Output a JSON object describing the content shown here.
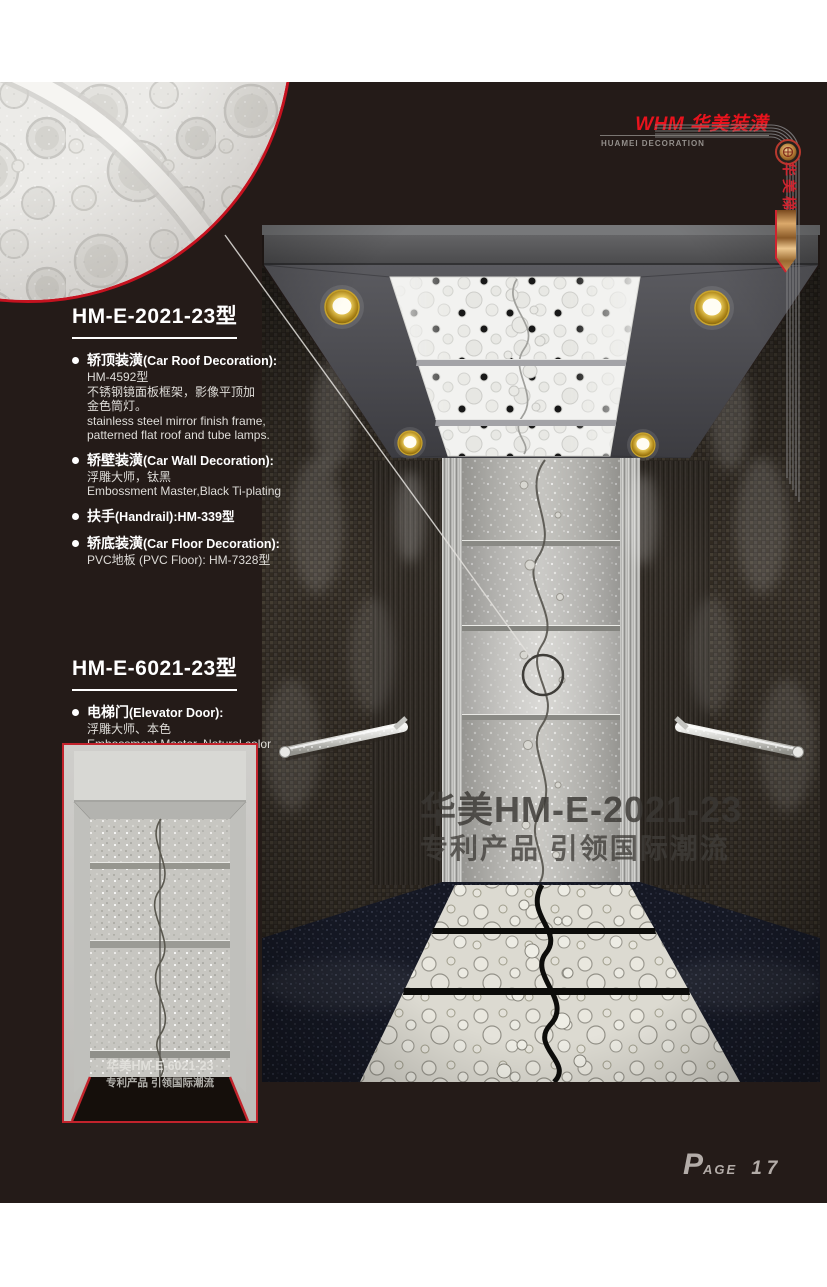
{
  "page": {
    "panel_color": "#241b18",
    "accent_red": "#c5121f",
    "footer": {
      "page_word_initial": "P",
      "page_word_rest": "AGE",
      "page_number": "17"
    }
  },
  "header": {
    "logo_title": "WHM 华美装潢",
    "logo_subtitle": "HUAMEI DECORATION",
    "banner_vertical_text": "华美梯"
  },
  "sections": [
    {
      "heading": "HM-E-2021-23型",
      "items": [
        {
          "zh": "轿顶装潢",
          "en": "(Car Roof Decoration):",
          "lines": [
            "HM-4592型",
            "不锈钢镜面板框架，影像平顶加",
            "金色筒灯。",
            "stainless steel mirror finish frame,",
            "patterned flat roof and tube lamps."
          ]
        },
        {
          "zh": "轿壁装潢",
          "en": "(Car Wall Decoration):",
          "lines": [
            "浮雕大师，钛黑",
            "Embossment Master,Black Ti-plating"
          ]
        },
        {
          "zh": "扶手",
          "en": "(Handrail):HM-339型",
          "lines": []
        },
        {
          "zh": "轿底装潢",
          "en": "(Car Floor Decoration):",
          "lines": [
            "PVC地板 (PVC Floor): HM-7328型"
          ]
        }
      ]
    },
    {
      "heading": "HM-E-6021-23型",
      "items": [
        {
          "zh": "电梯门",
          "en": "(Elevator Door):",
          "lines": [
            "浮雕大师、本色",
            "Embossment Master, Natural color"
          ]
        }
      ]
    }
  ],
  "main_image": {
    "watermark_line1": "华美HM-E-2021-23",
    "watermark_line2": "专利产品 引领国际潮流"
  },
  "door_image": {
    "watermark_line1": "华美HM-E-6021-23",
    "watermark_line2": "专利产品 引领国际潮流"
  }
}
